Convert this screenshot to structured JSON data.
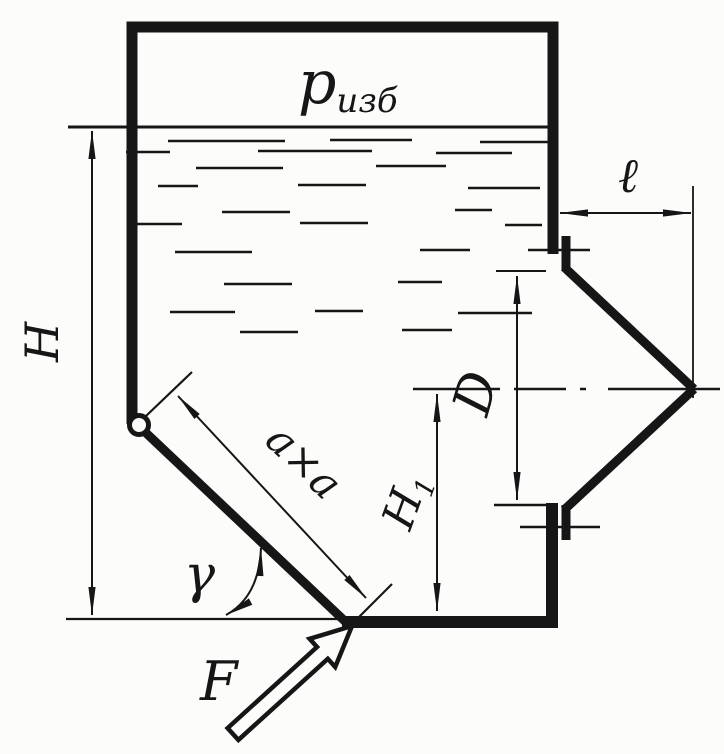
{
  "figure": {
    "type": "hydraulics-tank-diagram",
    "description": "Hand-drawn tank with pressurized gas above liquid, hinged square flap held by force, and conical nozzle outlet",
    "background_color": "#fcfcfa",
    "ink_color": "#161616"
  },
  "labels": {
    "gauge_pressure": {
      "main": "p",
      "sub": "изб"
    },
    "liquid_height": "H",
    "nozzle_length": "ℓ",
    "nozzle_diameter": "D",
    "flap_height": {
      "main": "H",
      "sub": "1"
    },
    "flap_size": "a×a",
    "flap_angle": "γ",
    "force": "F"
  }
}
